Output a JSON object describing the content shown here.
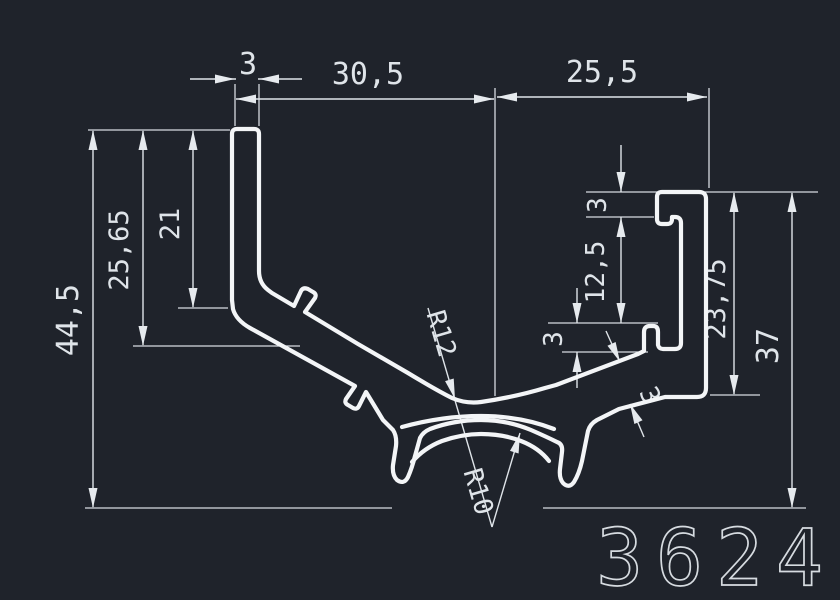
{
  "drawing": {
    "part_number": "3624",
    "colors": {
      "background": "#1f232b",
      "profile_line": "#f3f5f7",
      "dimension_line": "#dfe4e9",
      "text": "#dfe4e9",
      "part_number_text": "#d6dbe0"
    },
    "dimensions": {
      "bar_width": "3",
      "span_left": "30,5",
      "span_right": "25,5",
      "overall_height": "44,5",
      "bend_depth": "25,65",
      "inner_drop": "21",
      "lip_hook": "3",
      "slot_opening": "12,5",
      "bottom_hook": "3",
      "wall_thickness": "3",
      "channel_height": "23,75",
      "right_height": "37",
      "radius_large": "R12",
      "radius_small": "R10"
    }
  }
}
